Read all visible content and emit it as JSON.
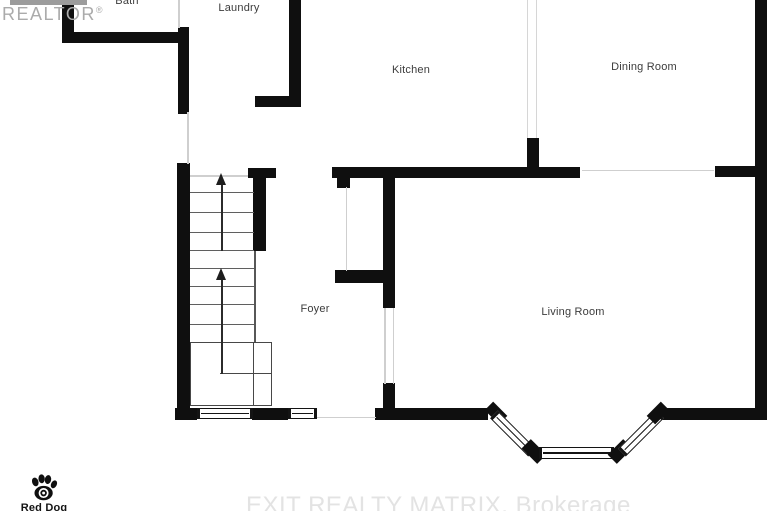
{
  "branding": {
    "realtor_logo": "REALTOR",
    "registered_symbol": "®",
    "red_dog_name": "Red Dog",
    "watermark": "EXIT REALTY MATRIX, Brokerage"
  },
  "rooms": {
    "bath": "Bath",
    "laundry": "Laundry",
    "kitchen": "Kitchen",
    "dining": "Dining Room",
    "foyer": "Foyer",
    "living": "Living Room"
  },
  "stairs": {
    "direction_arrows": 2,
    "arrow_meaning": "up"
  },
  "icons": {
    "paw": "paw-print-icon",
    "stair_arrow_1": "up-arrow-icon",
    "stair_arrow_2": "up-arrow-icon"
  },
  "colors": {
    "wall": "#0f0f0f",
    "label_text": "#3c3c3c",
    "realtor_gray": "#ababab",
    "watermark_gray": "#e3e3e3",
    "thin_line": "#cfcfcf",
    "background": "#ffffff"
  }
}
